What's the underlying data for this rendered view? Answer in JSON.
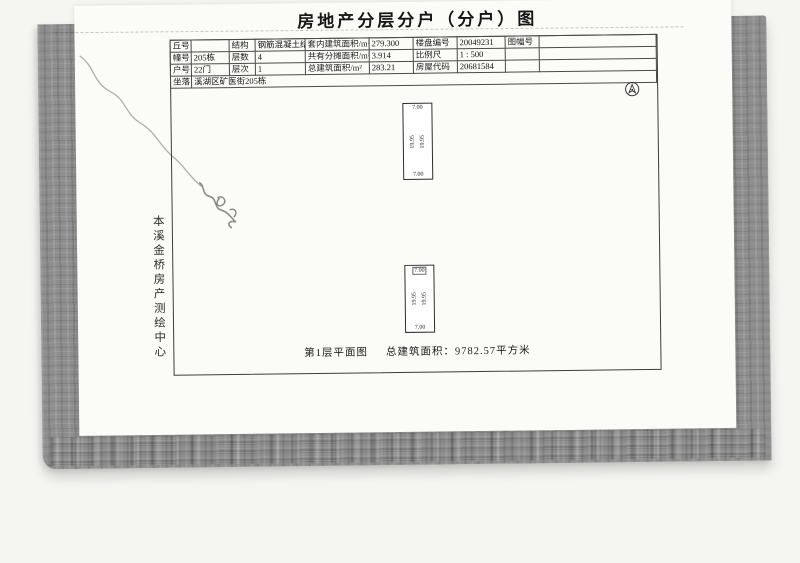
{
  "page": {
    "title": "房地产分层分户（分户）图"
  },
  "agency": {
    "name": "本溪金桥房产测绘中心"
  },
  "info_table": {
    "rows": [
      {
        "cells": [
          {
            "label": "丘号",
            "value": ""
          },
          {
            "label": "结构",
            "value": "钢筋混凝土结构"
          },
          {
            "label": "套内建筑面积/m²",
            "value": "279.300"
          },
          {
            "label": "楼盘编号",
            "value": "20049231"
          },
          {
            "label": "图幅号",
            "value": ""
          }
        ]
      },
      {
        "cells": [
          {
            "label": "幢号",
            "value": "205栋"
          },
          {
            "label": "层数",
            "value": "4"
          },
          {
            "label": "共有分摊面积/m²",
            "value": "3.914"
          },
          {
            "label": "比例尺",
            "value": "1 : 500"
          },
          {
            "label": "",
            "value": ""
          }
        ]
      },
      {
        "cells": [
          {
            "label": "户号",
            "value": "22门"
          },
          {
            "label": "层次",
            "value": "1"
          },
          {
            "label": "总建筑面积/m²",
            "value": "283.21"
          },
          {
            "label": "房屋代码",
            "value": "20681584"
          },
          {
            "label": "",
            "value": ""
          }
        ]
      }
    ],
    "location": {
      "label": "坐落",
      "value": "溪湖区矿医街205栋"
    }
  },
  "plan": {
    "units": [
      {
        "width_top": "7.00",
        "width_bottom": "7.00",
        "length_left": "19.95",
        "length_right": "19.95"
      },
      {
        "width_top": "7.00",
        "width_bottom": "7.00",
        "length_left": "19.95",
        "length_right": "19.95"
      }
    ],
    "caption_title": "第1层平面图",
    "caption_area": "总建筑面积：9782.57平方米"
  },
  "colors": {
    "cover_gray": "#8e8e8e",
    "sheet_white": "#fbfbf8",
    "ink": "#1d1d1d"
  }
}
